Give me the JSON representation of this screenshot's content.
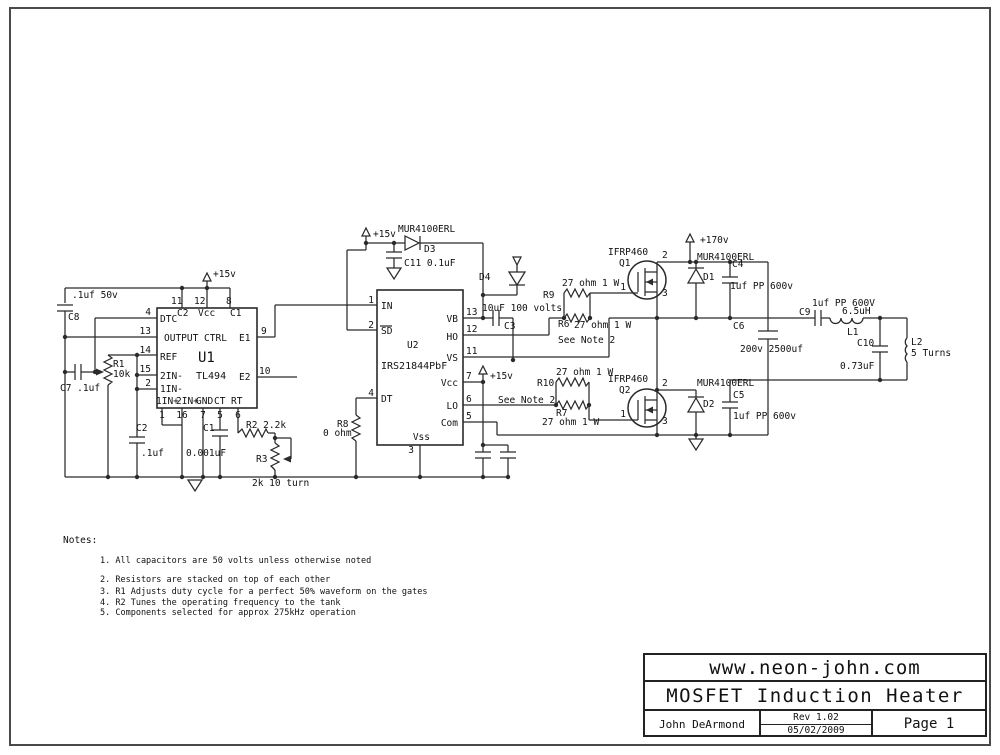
{
  "page": {
    "background": "#ffffff",
    "border_color": "#4a4a4a",
    "wire_color": "#2a2a2a",
    "text_color": "#111111"
  },
  "title_block": {
    "website": "www.neon-john.com",
    "title": "MOSFET Induction Heater",
    "author": "John DeArmond",
    "rev": "Rev 1.02",
    "date": "05/02/2009",
    "page": "Page 1"
  },
  "notes": {
    "heading": "Notes:",
    "items": [
      "1. All capacitors are 50 volts unless otherwise noted",
      "2. Resistors are stacked on top of each other",
      "3. R1 Adjusts duty cycle for a perfect 50% waveform on the gates",
      "4. R2 Tunes the operating frequency to the tank",
      "5. Components selected for approx 275kHz operation"
    ]
  },
  "labels": [
    {
      "name": "cap-c8-value",
      "text": ".1uf 50v",
      "x": 72,
      "y": 298
    },
    {
      "name": "cap-c8-ref",
      "text": "C8",
      "x": 68,
      "y": 320
    },
    {
      "name": "cap-c7-label",
      "text": "C7 .1uf",
      "x": 60,
      "y": 391
    },
    {
      "name": "pot-r1-ref",
      "text": "R1",
      "x": 113,
      "y": 367
    },
    {
      "name": "pot-r1-value",
      "text": "10k",
      "x": 113,
      "y": 377
    },
    {
      "name": "u1-plus15v-label",
      "text": "+15v",
      "x": 213,
      "y": 277
    },
    {
      "name": "u1-pin11-num",
      "text": "11",
      "x": 171,
      "y": 304
    },
    {
      "name": "u1-pin12-num",
      "text": "12",
      "x": 194,
      "y": 304
    },
    {
      "name": "u1-pin8-num",
      "text": "8",
      "x": 226,
      "y": 304
    },
    {
      "name": "u1-pin4-num",
      "text": "4",
      "x": 151,
      "y": 315,
      "anchor": "end"
    },
    {
      "name": "u1-pin13-num",
      "text": "13",
      "x": 151,
      "y": 334,
      "anchor": "end"
    },
    {
      "name": "u1-pin14-num",
      "text": "14",
      "x": 151,
      "y": 353,
      "anchor": "end"
    },
    {
      "name": "u1-pin15-num",
      "text": "15",
      "x": 151,
      "y": 372,
      "anchor": "end"
    },
    {
      "name": "u1-pin2-num",
      "text": "2",
      "x": 151,
      "y": 386,
      "anchor": "end"
    },
    {
      "name": "u1-pin9-num",
      "text": "9",
      "x": 261,
      "y": 334
    },
    {
      "name": "u1-pin10-num",
      "text": "10",
      "x": 259,
      "y": 374
    },
    {
      "name": "u1-label-dtc",
      "text": "DTC",
      "x": 160,
      "y": 322
    },
    {
      "name": "u1-label-c2pin",
      "text": "C2",
      "x": 177,
      "y": 316
    },
    {
      "name": "u1-label-vccpin",
      "text": "Vcc",
      "x": 198,
      "y": 316
    },
    {
      "name": "u1-label-c1pin",
      "text": "C1",
      "x": 230,
      "y": 316
    },
    {
      "name": "u1-label-outputctrl",
      "text": "OUTPUT CTRL",
      "x": 164,
      "y": 341
    },
    {
      "name": "u1-label-ref",
      "text": "REF",
      "x": 160,
      "y": 360
    },
    {
      "name": "u1-name",
      "text": "U1",
      "x": 198,
      "y": 362,
      "size": 14
    },
    {
      "name": "u1-label-2in-",
      "text": "2IN-",
      "x": 160,
      "y": 379
    },
    {
      "name": "u1-part",
      "text": "TL494",
      "x": 196,
      "y": 379,
      "size": 10
    },
    {
      "name": "u1-label-1in-",
      "text": "1IN-",
      "x": 160,
      "y": 392
    },
    {
      "name": "u1-label-1in+",
      "text": "1IN+",
      "x": 156,
      "y": 404
    },
    {
      "name": "u1-label-2in+",
      "text": "2IN+",
      "x": 176,
      "y": 404
    },
    {
      "name": "u1-label-gnd",
      "text": "GND",
      "x": 196,
      "y": 404
    },
    {
      "name": "u1-label-ct",
      "text": "CT",
      "x": 214,
      "y": 404
    },
    {
      "name": "u1-label-rt",
      "text": "RT",
      "x": 231,
      "y": 404
    },
    {
      "name": "u1-label-e1",
      "text": "E1",
      "x": 239,
      "y": 341
    },
    {
      "name": "u1-label-e2",
      "text": "E2",
      "x": 239,
      "y": 380
    },
    {
      "name": "u1-pin1-num",
      "text": "1",
      "x": 162,
      "y": 418,
      "anchor": "middle"
    },
    {
      "name": "u1-pin16-num",
      "text": "16",
      "x": 182,
      "y": 418,
      "anchor": "middle"
    },
    {
      "name": "u1-pin7-num",
      "text": "7",
      "x": 203,
      "y": 418,
      "anchor": "middle"
    },
    {
      "name": "u1-pin5-num",
      "text": "5",
      "x": 220,
      "y": 418,
      "anchor": "middle"
    },
    {
      "name": "u1-pin6-num",
      "text": "6",
      "x": 238,
      "y": 418,
      "anchor": "middle"
    },
    {
      "name": "cap-c2-ref",
      "text": "C2",
      "x": 136,
      "y": 431
    },
    {
      "name": "cap-c2-value",
      "text": ".1uf",
      "x": 141,
      "y": 456
    },
    {
      "name": "cap-c1-ref",
      "text": "C1",
      "x": 203,
      "y": 431
    },
    {
      "name": "cap-c1-value",
      "text": "0.001uF",
      "x": 186,
      "y": 456
    },
    {
      "name": "res-r2-label",
      "text": "R2 2.2k",
      "x": 246,
      "y": 428
    },
    {
      "name": "pot-r3-ref",
      "text": "R3",
      "x": 256,
      "y": 462
    },
    {
      "name": "pot-r3-value",
      "text": "2k 10 turn",
      "x": 252,
      "y": 486
    },
    {
      "name": "res-r8-ref",
      "text": "R8",
      "x": 337,
      "y": 427
    },
    {
      "name": "res-r8-value",
      "text": "0 ohm",
      "x": 323,
      "y": 436
    },
    {
      "name": "d3-plus15v-label",
      "text": "+15v",
      "x": 373,
      "y": 237
    },
    {
      "name": "d3-part",
      "text": "MUR4100ERL",
      "x": 398,
      "y": 232
    },
    {
      "name": "d3-ref",
      "text": "D3",
      "x": 424,
      "y": 252
    },
    {
      "name": "cap-c11-label",
      "text": "C11 0.1uF",
      "x": 404,
      "y": 266
    },
    {
      "name": "d4-ref",
      "text": "D4",
      "x": 479,
      "y": 280
    },
    {
      "name": "cap-c3-value",
      "text": "10uF 100 volts",
      "x": 482,
      "y": 311
    },
    {
      "name": "cap-c3-ref",
      "text": "C3",
      "x": 504,
      "y": 329
    },
    {
      "name": "u2-pin1-num",
      "text": "1",
      "x": 374,
      "y": 303,
      "anchor": "end"
    },
    {
      "name": "u2-pin2-num",
      "text": "2",
      "x": 374,
      "y": 328,
      "anchor": "end"
    },
    {
      "name": "u2-pin4-num",
      "text": "4",
      "x": 374,
      "y": 396,
      "anchor": "end"
    },
    {
      "name": "u2-label-in",
      "text": "IN",
      "x": 381,
      "y": 309
    },
    {
      "name": "u2-label-sd",
      "text": "SD",
      "x": 381,
      "y": 334
    },
    {
      "name": "u2-name",
      "text": "U2",
      "x": 407,
      "y": 348
    },
    {
      "name": "u2-part",
      "text": "IRS21844PbF",
      "x": 381,
      "y": 369,
      "size": 10
    },
    {
      "name": "u2-label-dt",
      "text": "DT",
      "x": 381,
      "y": 402
    },
    {
      "name": "u2-pin13-num",
      "text": "13",
      "x": 466,
      "y": 315
    },
    {
      "name": "u2-pin12-num",
      "text": "12",
      "x": 466,
      "y": 332
    },
    {
      "name": "u2-pin11-num",
      "text": "11",
      "x": 466,
      "y": 354
    },
    {
      "name": "u2-pin7-num",
      "text": "7",
      "x": 466,
      "y": 379
    },
    {
      "name": "u2-pin6-num",
      "text": "6",
      "x": 466,
      "y": 402
    },
    {
      "name": "u2-pin5-num",
      "text": "5",
      "x": 466,
      "y": 419
    },
    {
      "name": "u2-label-vb",
      "text": "VB",
      "x": 458,
      "y": 322,
      "anchor": "end"
    },
    {
      "name": "u2-label-ho",
      "text": "HO",
      "x": 458,
      "y": 340,
      "anchor": "end"
    },
    {
      "name": "u2-label-vs",
      "text": "VS",
      "x": 458,
      "y": 361,
      "anchor": "end"
    },
    {
      "name": "u2-label-vcc",
      "text": "Vcc",
      "x": 458,
      "y": 386,
      "anchor": "end"
    },
    {
      "name": "u2-label-lo",
      "text": "LO",
      "x": 458,
      "y": 409,
      "anchor": "end"
    },
    {
      "name": "u2-label-com",
      "text": "Com",
      "x": 458,
      "y": 426,
      "anchor": "end"
    },
    {
      "name": "u2-label-vss",
      "text": "Vss",
      "x": 430,
      "y": 440,
      "anchor": "end"
    },
    {
      "name": "u2-pin3-num",
      "text": "3",
      "x": 414,
      "y": 453,
      "anchor": "end"
    },
    {
      "name": "u2-plus15v-label",
      "text": "+15v",
      "x": 490,
      "y": 379
    },
    {
      "name": "lo-see-note",
      "text": "See Note 2",
      "x": 498,
      "y": 403
    },
    {
      "name": "res-r10-ref",
      "text": "R10",
      "x": 537,
      "y": 386
    },
    {
      "name": "res-r10-value",
      "text": "27 ohm 1 W",
      "x": 556,
      "y": 375
    },
    {
      "name": "res-r7-ref",
      "text": "R7",
      "x": 556,
      "y": 416
    },
    {
      "name": "res-r7-value",
      "text": "27 ohm 1 W",
      "x": 542,
      "y": 425
    },
    {
      "name": "res-r9-ref",
      "text": "R9",
      "x": 543,
      "y": 298
    },
    {
      "name": "res-r9-value",
      "text": "27 ohm 1 W",
      "x": 562,
      "y": 286
    },
    {
      "name": "res-r6-ref",
      "text": "R6",
      "x": 558,
      "y": 327
    },
    {
      "name": "res-r6-value",
      "text": "27 ohm 1 W",
      "x": 574,
      "y": 328
    },
    {
      "name": "ho-see-note",
      "text": "See Note 2",
      "x": 558,
      "y": 343
    },
    {
      "name": "q1-part",
      "text": "IFRP460",
      "x": 608,
      "y": 255
    },
    {
      "name": "q1-ref",
      "text": "Q1",
      "x": 619,
      "y": 266
    },
    {
      "name": "q1-pin1-num",
      "text": "1",
      "x": 626,
      "y": 290,
      "anchor": "end"
    },
    {
      "name": "q1-pin2-num",
      "text": "2",
      "x": 662,
      "y": 258
    },
    {
      "name": "q1-pin3-num",
      "text": "3",
      "x": 662,
      "y": 296
    },
    {
      "name": "plus170v-label",
      "text": "+170v",
      "x": 700,
      "y": 243
    },
    {
      "name": "d1-part",
      "text": "MUR4100ERL",
      "x": 697,
      "y": 260
    },
    {
      "name": "d1-ref",
      "text": "D1",
      "x": 703,
      "y": 280
    },
    {
      "name": "cap-c4-ref",
      "text": "C4",
      "x": 732,
      "y": 267
    },
    {
      "name": "cap-c4-value",
      "text": "1uf PP 600v",
      "x": 730,
      "y": 289
    },
    {
      "name": "cap-c6-ref",
      "text": "C6",
      "x": 733,
      "y": 329
    },
    {
      "name": "cap-c6-value",
      "text": "200v 2500uf",
      "x": 740,
      "y": 352
    },
    {
      "name": "q2-part",
      "text": "IFRP460",
      "x": 608,
      "y": 382
    },
    {
      "name": "q2-ref",
      "text": "Q2",
      "x": 619,
      "y": 393
    },
    {
      "name": "q2-pin1-num",
      "text": "1",
      "x": 626,
      "y": 417,
      "anchor": "end"
    },
    {
      "name": "q2-pin2-num",
      "text": "2",
      "x": 662,
      "y": 386
    },
    {
      "name": "q2-pin3-num",
      "text": "3",
      "x": 662,
      "y": 424
    },
    {
      "name": "d2-part",
      "text": "MUR4100ERL",
      "x": 697,
      "y": 386
    },
    {
      "name": "d2-ref",
      "text": "D2",
      "x": 703,
      "y": 407
    },
    {
      "name": "cap-c5-ref",
      "text": "C5",
      "x": 733,
      "y": 398
    },
    {
      "name": "cap-c5-value",
      "text": "1uf PP 600v",
      "x": 733,
      "y": 419
    },
    {
      "name": "cap-c9-value",
      "text": "1uf PP 600V",
      "x": 812,
      "y": 306
    },
    {
      "name": "cap-c9-ref",
      "text": "C9",
      "x": 799,
      "y": 315
    },
    {
      "name": "ind-l1-value",
      "text": "6.5uH",
      "x": 842,
      "y": 314
    },
    {
      "name": "ind-l1-ref",
      "text": "L1",
      "x": 847,
      "y": 335
    },
    {
      "name": "cap-c10-ref",
      "text": "C10",
      "x": 857,
      "y": 346
    },
    {
      "name": "cap-c10-value",
      "text": "0.73uF",
      "x": 840,
      "y": 369
    },
    {
      "name": "ind-l2-ref",
      "text": "L2",
      "x": 911,
      "y": 345
    },
    {
      "name": "ind-l2-value",
      "text": "5 Turns",
      "x": 911,
      "y": 356
    }
  ]
}
